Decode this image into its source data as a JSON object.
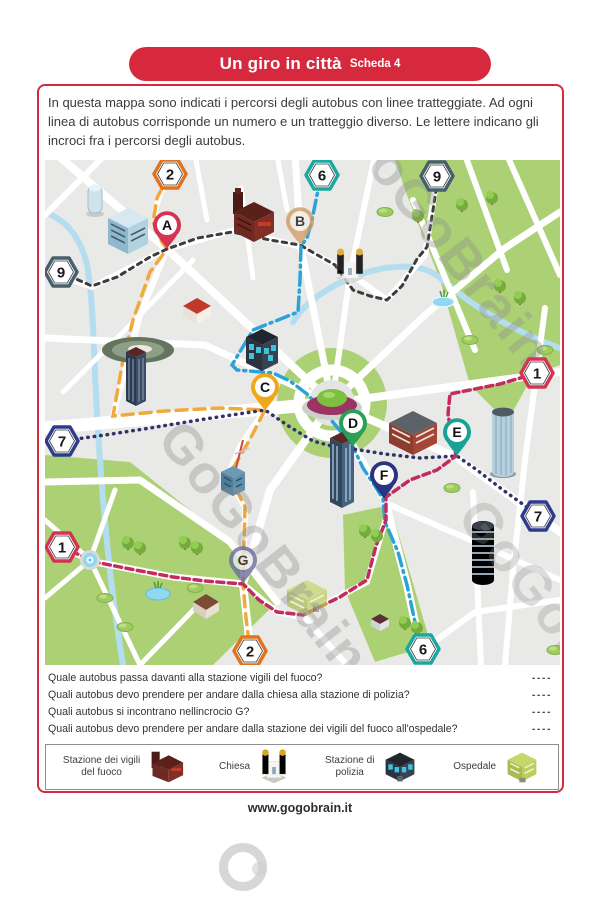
{
  "page": {
    "banner": {
      "title": "Un giro in città",
      "subtitle": "Scheda 4"
    },
    "intro": "In questa mappa sono indicati i percorsi degli autobus con linee tratteggiate. Ad ogni linea di autobus corrisponde un numero e un tratteggio diverso. Le lettere indicano gli incroci fra i percorsi degli autobus.",
    "footer": "www.gogobrain.it",
    "accent_color": "#d7293d"
  },
  "map": {
    "watermark_text": "GoGoBrain",
    "background": "#e9e9e7",
    "road_color": "#ffffff",
    "park_color": "#abd174",
    "river_color": "#b5ddf0",
    "badges": [
      {
        "label": "2",
        "color": "#e1731f"
      },
      {
        "label": "6",
        "color": "#1ba8a0"
      },
      {
        "label": "9",
        "color": "#46616d"
      },
      {
        "label": "9",
        "color": "#46616d"
      },
      {
        "label": "7",
        "color": "#2e3b8f"
      },
      {
        "label": "1",
        "color": "#d63352"
      },
      {
        "label": "1",
        "color": "#d63352"
      },
      {
        "label": "7",
        "color": "#2e3b8f"
      },
      {
        "label": "2",
        "color": "#e1731f"
      },
      {
        "label": "6",
        "color": "#1ba8a0"
      }
    ],
    "pins": [
      {
        "label": "A",
        "color": "#d63352"
      },
      {
        "label": "B",
        "color": "#d09a66"
      },
      {
        "label": "C",
        "color": "#f0a81b"
      },
      {
        "label": "D",
        "color": "#2aa055"
      },
      {
        "label": "E",
        "color": "#16a295"
      },
      {
        "label": "F",
        "color": "#2b3480"
      },
      {
        "label": "G",
        "color": "#6b6e9b"
      }
    ],
    "routes": [
      {
        "number": "2",
        "color": "#f2a93b",
        "style": "long-dash"
      },
      {
        "number": "9",
        "color": "#3c3c3c",
        "style": "dotted"
      },
      {
        "number": "6",
        "color": "#2ba3d8",
        "style": "dash-dot"
      },
      {
        "number": "7",
        "color": "#32336b",
        "style": "fine-dots"
      },
      {
        "number": "1",
        "color": "#c42a5e",
        "style": "short-dash"
      }
    ]
  },
  "questions": [
    {
      "text": "Quale autobus passa davanti alla stazione vigili del fuoco?",
      "blank": "----"
    },
    {
      "text": "Quali autobus devo prendere per andare dalla chiesa alla stazione di polizia?",
      "blank": "----"
    },
    {
      "text": "Quali autobus si incontrano nellincrocio G?",
      "blank": "----"
    },
    {
      "text": "Quali autobus devo prendere per andare dalla stazione dei vigili del fuoco all'ospedale?",
      "blank": "----"
    }
  ],
  "legend": {
    "items": [
      {
        "label": "Stazione dei vigili\ndel fuoco"
      },
      {
        "label": "Chiesa"
      },
      {
        "label": "Stazione di\npolizia"
      },
      {
        "label": "Ospedale"
      }
    ]
  }
}
